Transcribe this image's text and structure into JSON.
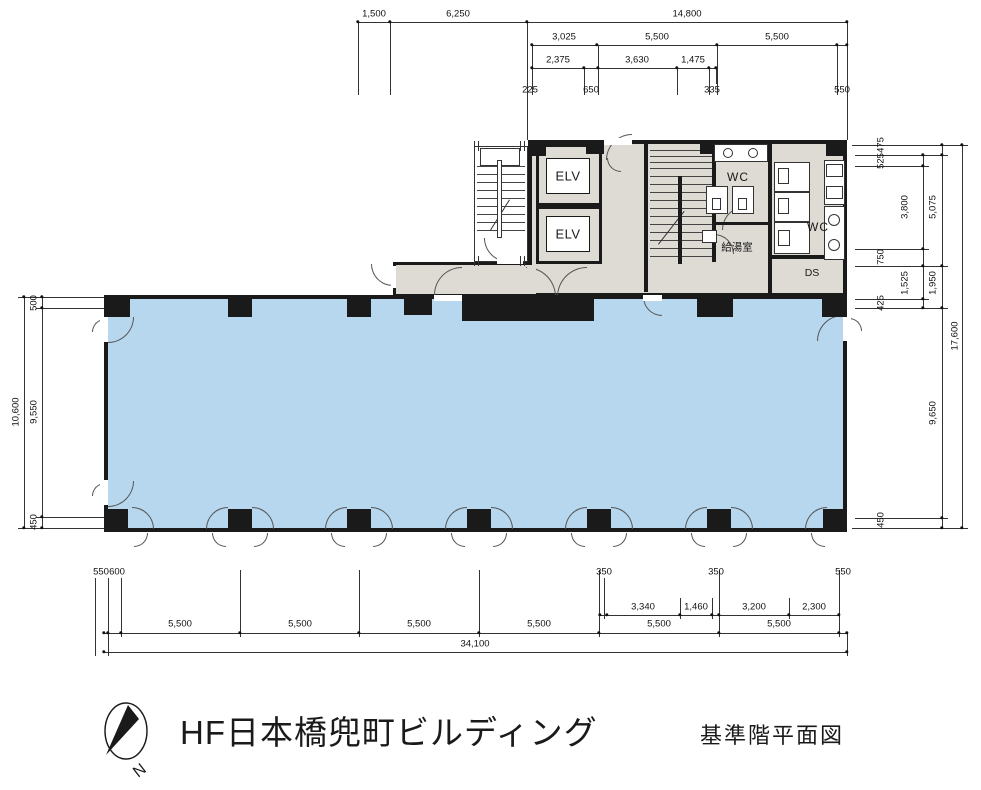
{
  "titleblock": {
    "building_name": "HF日本橋兜町ビルディング",
    "drawing_title": "基準階平面図",
    "north_label": "N"
  },
  "rooms": {
    "elevator_1": "ELV",
    "elevator_2": "ELV",
    "wc_left": "WC",
    "wc_right": "WC",
    "kitchen": "給湯室",
    "duct_space": "DS",
    "pipe_space": "PS",
    "electrical_pipe_space": "EPS"
  },
  "colors": {
    "room_fill": "#b7d7ef",
    "core_fill": "#dedad4",
    "wall": "#1a1a1a"
  },
  "dimensions": {
    "top": [
      {
        "t": "1,500",
        "x": 374,
        "y": 14
      },
      {
        "t": "6,250",
        "x": 458,
        "y": 14
      },
      {
        "t": "14,800",
        "x": 687,
        "y": 14
      },
      {
        "t": "3,025",
        "x": 564,
        "y": 37
      },
      {
        "t": "5,500",
        "x": 657,
        "y": 37
      },
      {
        "t": "5,500",
        "x": 777,
        "y": 37
      },
      {
        "t": "2,375",
        "x": 558,
        "y": 60
      },
      {
        "t": "3,630",
        "x": 637,
        "y": 60
      },
      {
        "t": "1,475",
        "x": 693,
        "y": 60
      },
      {
        "t": "225",
        "x": 530,
        "y": 90
      },
      {
        "t": "650",
        "x": 591,
        "y": 90
      },
      {
        "t": "335",
        "x": 712,
        "y": 90
      },
      {
        "t": "550",
        "x": 842,
        "y": 90
      }
    ],
    "right": [
      {
        "t": "475",
        "x": 881,
        "y": 145,
        "r": 1
      },
      {
        "t": "525",
        "x": 881,
        "y": 161,
        "r": 1
      },
      {
        "t": "3,800",
        "x": 905,
        "y": 207,
        "r": 1
      },
      {
        "t": "5,075",
        "x": 933,
        "y": 207,
        "r": 1
      },
      {
        "t": "750",
        "x": 881,
        "y": 257,
        "r": 1
      },
      {
        "t": "1,525",
        "x": 905,
        "y": 283,
        "r": 1
      },
      {
        "t": "1,950",
        "x": 933,
        "y": 283,
        "r": 1
      },
      {
        "t": "425",
        "x": 881,
        "y": 303,
        "r": 1
      },
      {
        "t": "17,600",
        "x": 955,
        "y": 336,
        "r": 1
      },
      {
        "t": "9,650",
        "x": 933,
        "y": 413,
        "r": 1
      },
      {
        "t": "450",
        "x": 881,
        "y": 520,
        "r": 1
      }
    ],
    "left": [
      {
        "t": "500",
        "x": 34,
        "y": 303,
        "r": 1
      },
      {
        "t": "9,550",
        "x": 34,
        "y": 412,
        "r": 1
      },
      {
        "t": "450",
        "x": 34,
        "y": 522,
        "r": 1
      },
      {
        "t": "10,600",
        "x": 16,
        "y": 412,
        "r": 1
      }
    ],
    "bottom": [
      {
        "t": "550",
        "x": 101,
        "y": 572
      },
      {
        "t": "600",
        "x": 117,
        "y": 572
      },
      {
        "t": "350",
        "x": 604,
        "y": 572
      },
      {
        "t": "350",
        "x": 716,
        "y": 572
      },
      {
        "t": "550",
        "x": 843,
        "y": 572
      },
      {
        "t": "3,340",
        "x": 643,
        "y": 607
      },
      {
        "t": "1,460",
        "x": 696,
        "y": 607
      },
      {
        "t": "3,200",
        "x": 754,
        "y": 607
      },
      {
        "t": "2,300",
        "x": 814,
        "y": 607
      },
      {
        "t": "5,500",
        "x": 180,
        "y": 624
      },
      {
        "t": "5,500",
        "x": 300,
        "y": 624
      },
      {
        "t": "5,500",
        "x": 419,
        "y": 624
      },
      {
        "t": "5,500",
        "x": 539,
        "y": 624
      },
      {
        "t": "5,500",
        "x": 659,
        "y": 624
      },
      {
        "t": "5,500",
        "x": 779,
        "y": 624
      },
      {
        "t": "34,100",
        "x": 475,
        "y": 644
      }
    ]
  }
}
